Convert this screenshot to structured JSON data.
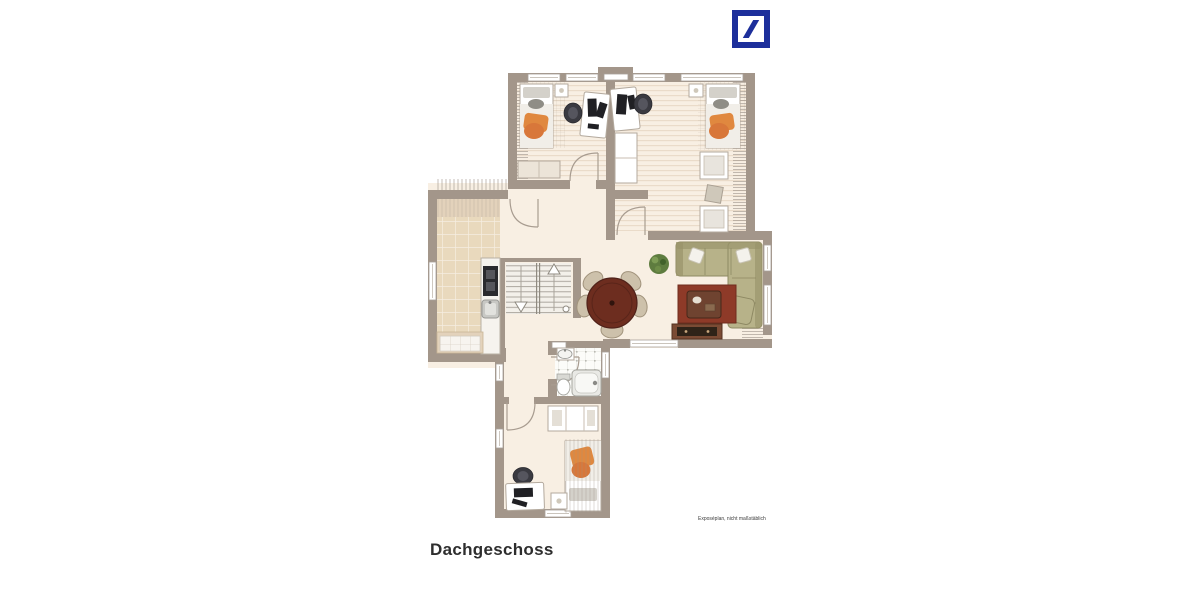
{
  "brand": {
    "logo_icon": "deutsche-bank-logo",
    "logo_color": "#1d2f9b"
  },
  "floorplan": {
    "caption": "Dachgeschoss",
    "disclaimer": "Exposéplan, nicht maßstäblich",
    "rooms": [
      {
        "name": "bedroom-top-left",
        "furniture": [
          "bed-icon",
          "pillow-icon",
          "orange-duvet-icon",
          "nightstand-icon",
          "desk-icon",
          "laptop-icon",
          "office-chair-icon",
          "low-cabinet-icon"
        ]
      },
      {
        "name": "bedroom-top-right",
        "furniture": [
          "bed-icon",
          "pillow-icon",
          "orange-duvet-icon",
          "nightstand-icon",
          "desk-icon",
          "laptop-icon",
          "office-chair-icon",
          "wardrobe-icon",
          "storage-box-icon"
        ]
      },
      {
        "name": "kitchen",
        "furniture": [
          "counter-icon",
          "stove-icon",
          "sink-icon",
          "tile-floor"
        ]
      },
      {
        "name": "living-dining-room",
        "furniture": [
          "corner-sofa-icon",
          "cushion-icon",
          "rug-icon",
          "coffee-table-icon",
          "round-dining-table-icon",
          "dining-chair-icon",
          "sideboard-icon",
          "plant-icon"
        ]
      },
      {
        "name": "bathroom",
        "furniture": [
          "washbasin-icon",
          "toilet-icon",
          "bathtub-icon",
          "tile-floor"
        ]
      },
      {
        "name": "bedroom-bottom",
        "furniture": [
          "bed-icon",
          "pillow-icon",
          "orange-duvet-icon",
          "wardrobe-icon",
          "desk-icon",
          "laptop-icon",
          "office-chair-icon",
          "nightstand-icon"
        ]
      },
      {
        "name": "staircase",
        "furniture": [
          "stairs-icon",
          "up-arrow-icon",
          "down-arrow-icon"
        ]
      }
    ]
  },
  "colors": {
    "logo_blue": "#1d2f9b",
    "wall": "#a3968a",
    "floor": "#f8efe3",
    "floor_stripe": "#eadbc9",
    "tile": "#e9d9bd",
    "tile_line": "#f6eee1",
    "sofa": "#b7b289",
    "sofa_dark": "#98936a",
    "table_wood": "#6d2d1f",
    "rug": "#8e3a28",
    "coffee_table": "#6f4330",
    "accent": "#e0883f",
    "device": "#202024",
    "hatch": "#9b9186",
    "text": "#2e2e2e"
  }
}
